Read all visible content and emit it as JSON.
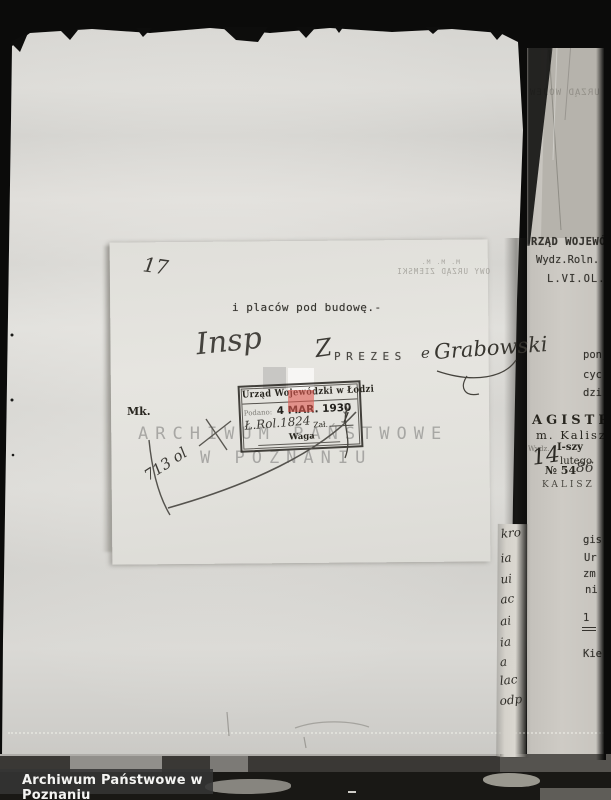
{
  "archive": {
    "caption": "Archiwum Państwowe w Poznaniu"
  },
  "watermark": {
    "line1": "ARCHIWUM PAŃSTWOWE",
    "line2": "W POZNANIU"
  },
  "inset_document": {
    "page_number": "17",
    "typed_line": "i placów pod budowę.-",
    "annotation_word": "Insp",
    "signature_prefix": "Z",
    "typed_title": "PREZES",
    "signature_connector": "e",
    "signature": "Grabowski",
    "margin_note": "Mk.",
    "diagonal_note": "713 ol",
    "showthrough_line1": "M. M. M.",
    "showthrough_line2": "OWY URZĄD ZIEMSKI"
  },
  "stamp": {
    "header": "Urząd Wojewódzki w Łodzi",
    "received_label": "Podano:",
    "date": "4 MAR. 1930",
    "date_mark": "y",
    "ref_handwritten": "Ł.Rol.1824",
    "attachment_label": "Zał.",
    "attachment_value": "1",
    "weight_label": "Waga"
  },
  "right_page": {
    "header_line1": "RZĄD WOJEWÓDZ",
    "header_line2": "Wydz.Roln. I",
    "header_line3": "L.VI.OL.",
    "mirror_text": "URZĄD WOJEW",
    "fragments_upper": [
      "pon",
      "cyc",
      "dzi"
    ],
    "magistrat": {
      "line1": "AGISTR",
      "line2": "m. Kalisz",
      "dept_label": "Wydz.",
      "dept": "I-szy",
      "day": "14",
      "month": "lutego",
      "number_label": "№ 54",
      "number_hand": "86",
      "city": "KALISZ"
    },
    "fragments_lower": [
      "gis",
      "Ur",
      "zm",
      "ni",
      "1",
      "Kie"
    ]
  },
  "margin_strip": {
    "fragments": [
      "kro",
      "ia",
      "ui",
      "ac",
      "ai",
      "ia",
      "a",
      "lac",
      "odp"
    ]
  },
  "colors": {
    "page": "#d7d6d2",
    "inset": "#e4e3de",
    "background": "#0b0b0a",
    "stamp_ink": "#28261f",
    "calibration_red": "#df5a52",
    "caption_bg": "#343434",
    "watermark_gray": "#767674"
  }
}
